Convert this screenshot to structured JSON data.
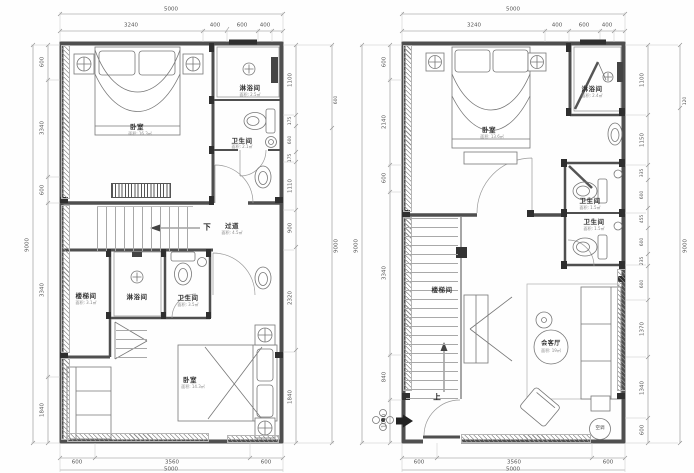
{
  "colors": {
    "wall": "#4f4f4f",
    "furniture": "#777777",
    "dimline": "#8a8a8a",
    "text": "#444444"
  },
  "plans": {
    "left": {
      "dims": {
        "top_overall": "5000",
        "top": [
          "3240",
          "400",
          "600",
          "400"
        ],
        "left_overall": "9000",
        "left": [
          "600",
          "3340",
          "600",
          "3340",
          "1840"
        ],
        "right_overall": "9000",
        "right_extra": "600",
        "right": [
          "1100",
          "175",
          "600",
          "175",
          "1110",
          "900",
          "2320",
          "1840"
        ],
        "bottom": [
          "600",
          "3560",
          "600"
        ],
        "bottom_overall": "5000"
      },
      "rooms": {
        "bedroom_top": {
          "name": "卧室",
          "area": "面积: 16.3㎡"
        },
        "shower_top": {
          "name": "淋浴间",
          "area": "面积: 2.5㎡"
        },
        "bath_top": {
          "name": "卫生间",
          "area": "面积: 2.1㎡"
        },
        "corridor": {
          "name": "过道",
          "area": "面积: 4.5㎡",
          "direction": "下"
        },
        "stair": {
          "name": "楼梯间",
          "area": "面积: 3.1㎡"
        },
        "shower_bottom": {
          "name": "淋浴间"
        },
        "bath_bottom": {
          "name": "卫生间",
          "area": "面积: 3.5㎡"
        },
        "bedroom_bottom": {
          "name": "卧室",
          "area": "面积: 14.3㎡"
        }
      }
    },
    "right": {
      "dims": {
        "top_overall": "5000",
        "top": [
          "3240",
          "400",
          "600",
          "400"
        ],
        "left_overall": "9000",
        "left": [
          "600",
          "2140",
          "600",
          "3340",
          "840",
          "1080"
        ],
        "right_overall": "9000",
        "right_extra": "120",
        "right": [
          "1100",
          "1150",
          "335",
          "600",
          "455",
          "600",
          "235",
          "600",
          "1370",
          "1340",
          "600"
        ],
        "bottom": [
          "600",
          "3560",
          "600"
        ],
        "bottom_overall": "5000"
      },
      "rooms": {
        "bedroom": {
          "name": "卧室",
          "area": "面积: 13.6㎡"
        },
        "shower": {
          "name": "淋浴间",
          "area": "面积: 2.4㎡"
        },
        "bath1": {
          "name": "卫生间",
          "area": "面积: 1.5㎡"
        },
        "bath2": {
          "name": "卫生间",
          "area": "面积: 1.5㎡"
        },
        "stair": {
          "name": "楼梯间"
        },
        "living": {
          "name": "会客厅",
          "area": "面积: 19㎡"
        },
        "up": "上",
        "ac": "空调"
      }
    }
  }
}
